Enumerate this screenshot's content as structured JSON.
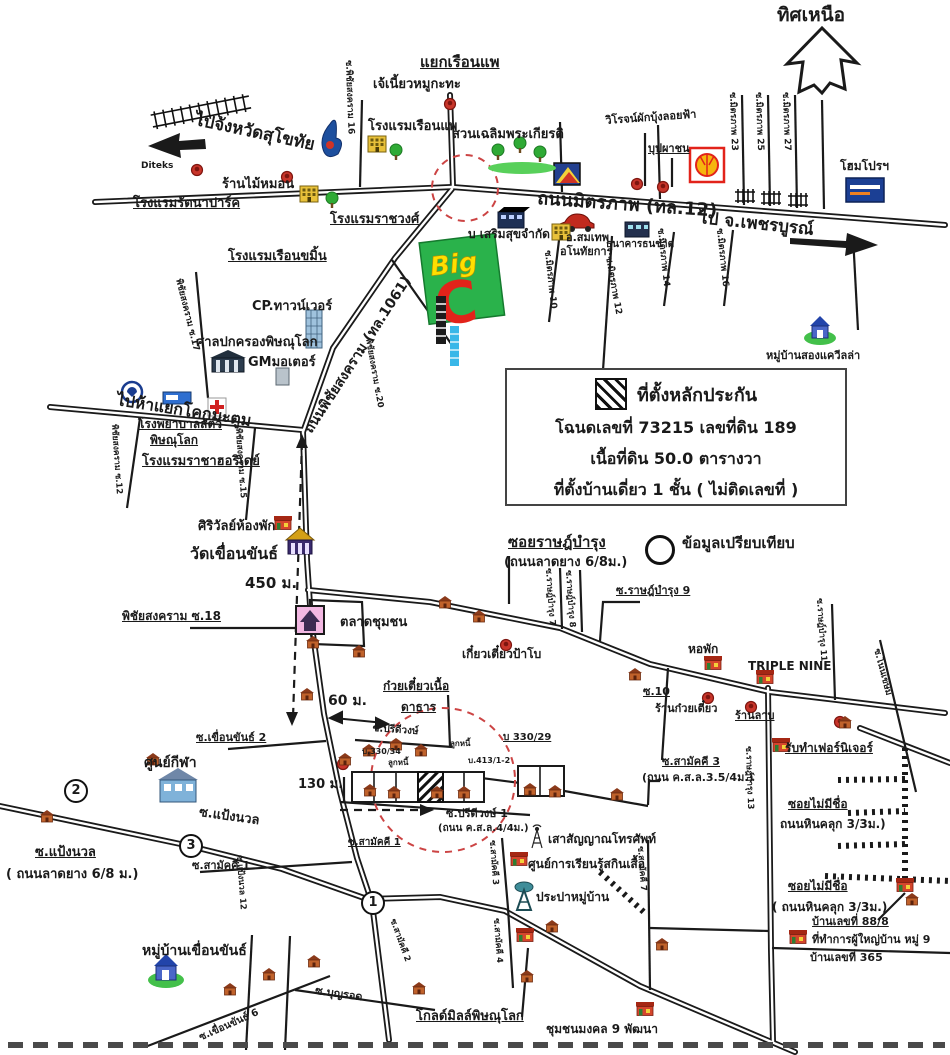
{
  "compass_label": "ทิศเหนือ",
  "legend": {
    "title": "ที่ตั้งหลักประกัน",
    "line1": "โฉนดเลขที่ 73215  เลขที่ดิน 189",
    "line2": "เนื้อที่ดิน 50.0 ตารางวา",
    "line3": "ที่ตั้งบ้านเดี่ยว 1 ชั้น  ( ไม่ติดเลขที่ )",
    "comparison_label": "ข้อมูลเปรียบเทียบ"
  },
  "markers": {
    "m1": "1",
    "m2": "2",
    "m3": "3"
  },
  "bigc": {
    "big": "Big",
    "c": "C"
  },
  "colors": {
    "road": "#1a1a1a",
    "red_dashed_circle": "#cc4444",
    "bigc_green": "#2ab24b",
    "bigc_red": "#e2231a",
    "bigc_yellow": "#ffdf00",
    "shell_yellow": "#f6b50e",
    "homepro_blue": "#1b3f94"
  },
  "labels": [
    "ทิศเหนือ",
    "ไปจังหวัดสุโขทัย",
    "Diteks",
    "ร้านไม้หมอน",
    "โรงแรมรัตนาปาร์ค",
    "โรงแรมเรือนขมิ้น",
    "โรงแรมราชวงศ์",
    "เจ้เนี้ยวหมูกะทะ",
    "แยกเรือนแพ",
    "โรงแรมเรือนแพ",
    "สวนเฉลิมพระเกียรติ",
    "ถนนมิตรภาพ (ทล.12)",
    "ไป จ.เพชรบูรณ์",
    "วิโรจน์ผักบุ้งลอยฟ้า",
    "บุปผาชน",
    "โฮมโปรฯ",
    "ซ.พิชัยสงคราม 16",
    "ซ.มิตรภาพ 23",
    "ซ.มิตรภาพ 25",
    "ซ.มิตรภาพ 27",
    "บ เสริมสุขจำกัด",
    "อ.สมเทพ",
    "อโนทัยการ",
    "ธนาคารธนชาต",
    "ซ.มิตรภาพ 10",
    "ซ.มิตรภาพ 12",
    "ซ.มิตรภาพ 14",
    "ซ.มิตรภาพ 16",
    "หมู่บ้านสองแควีลล่า",
    "CP.ทาวน์เวอร์",
    "ศาลปกครองพิษณุโลก",
    "GMมอเตอร์",
    "ไปห้าแยกโคกมะตูม",
    "ถนนพิชัยสงคราม (ทล.1061)",
    "พิชัยสงคราม ซ.17",
    "โรงพยาบาลสัตว์",
    "พิษณุโลก",
    "โรงแรมราชาฮอริเดย์",
    "พิชัยสงคราม ซ.12",
    "พิชัยสงคราม ซ.15",
    "ศิริวัลย์ห้องพัก",
    "วัดเขื่อนขันธ์",
    "450 ม.",
    "พิชัยสงคราม ซ.18",
    "ตลาดชุมชน",
    "ซอยราษฎ์บำรุง",
    "(ถนนลาดยาง 6/8ม.)",
    "ข้อมูลเปรียบเทียบ",
    "ซ.ราษฎ์บำรุง 9",
    "ซ.ราษฎ์บำรุง 7",
    "ซ.ราษฎ์บำรุง 8",
    "เกี๋ยวเตี๋ยวป้าโบ",
    "หอพัก",
    "TRIPLE NINE",
    "ซ.ราษฎ์บำรุง 11",
    "ซ.10",
    "ร้านก๋วยเตี๋ยว",
    "ร้านลาบ",
    "ซ.โนนเขษม",
    "รับทำเฟอร์นิเจอร์",
    "ซ.ราษฎ์บำรุง 13",
    "ซอยไม่มีชื่อ",
    "ถนนหินคลุก 3/3ม.)",
    "ซอยไม่มีชื่อ",
    "( ถนนหินคลุก 3/3ม.)",
    "บ้านเลขที่ 88/8",
    "ที่ทำการผู้ใหญ่บ้าน หมู่ 9",
    "บ้านเลขที่ 365",
    "ซ.สามัคคี 3",
    "(ถนน ค.ส.ล.3.5/4ม.)",
    "เสาสัญญาณโทรศัพท์",
    "ศูนย์การเรียนรู้สกินเสื้อ",
    "ประปาหมู่บ้าน",
    "ซ.สามัคคี 3",
    "ซ.สามัคคี 4",
    "ซ.สามัคคี 7",
    "โกลด์มิลล์พิษณุโลก",
    "ชุมชนมงคล 9 พัฒนา",
    "ศูนย์กีฬา",
    "ซ.แป้งนวล",
    "ซ.แป้งนวล",
    "( ถนนลาดยาง 6/8 ม.)",
    "ซ.แป้งนวล 12",
    "ซ.เขื่อนขันธ์ 2",
    "หมู่บ้านเขื่อนขันธ์",
    "ซ.เขื่อนขันธ์ 6",
    "ซ.บุญรอด",
    "ซ.สามัคคี 2",
    "ซ.สามัคคี 1",
    "ซ.สามัคคี 1",
    "ก๋วยเตี๋ยวเนื้อ",
    "ดาธาร",
    "ซ.ปรีดีวงษ์",
    "บ 330/29",
    "บ.330/34",
    "ลูกหนี้",
    "ลูกหนี้",
    "บ.413/1-2",
    "ซ.ปรีดีวงษ์ 1",
    "(ถนน ค.ส.ล.4/4ม.)",
    "60 ม.",
    "130 ม.",
    "พิชัยสงคราม ซ.20"
  ]
}
